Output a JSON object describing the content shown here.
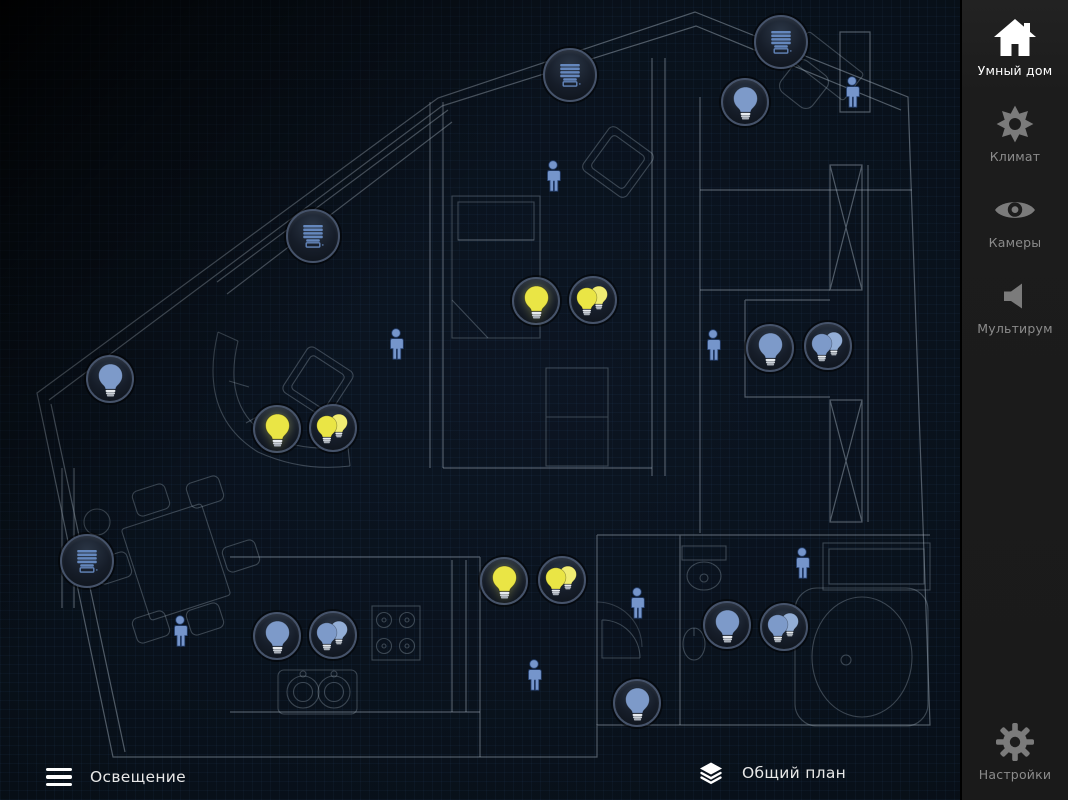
{
  "sidebar": {
    "items": [
      {
        "id": "smart-home",
        "label": "Умный дом",
        "icon": "home-icon",
        "active": true
      },
      {
        "id": "climate",
        "label": "Климат",
        "icon": "sun-icon",
        "active": false
      },
      {
        "id": "cameras",
        "label": "Камеры",
        "icon": "eye-icon",
        "active": false
      },
      {
        "id": "multiroom",
        "label": "Мультирум",
        "icon": "speaker-icon",
        "active": false
      }
    ],
    "settings": {
      "label": "Настройки",
      "icon": "gear-icon"
    }
  },
  "bottom_bar": {
    "lighting_menu": {
      "label": "Освещение",
      "icon": "hamburger-icon"
    },
    "plan_selector": {
      "label": "Общий план",
      "icon": "layers-icon"
    }
  },
  "colors": {
    "light_on": "#eae545",
    "light_on_back": "#f0ec73",
    "light_off": "#7d9ac9",
    "light_off_back": "#93aed6",
    "blinds_icon": "#6487bd",
    "presence": "#7595cb",
    "device_ring": "#46536a",
    "device_bg": "#141b26",
    "sidebar_active": "#ffffff",
    "sidebar_inactive": "#8b8b8b",
    "plan_line": "#a6b4c2"
  },
  "devices": [
    {
      "type": "blinds",
      "x": 570,
      "y": 75
    },
    {
      "type": "blinds",
      "x": 781,
      "y": 42
    },
    {
      "type": "blinds",
      "x": 313,
      "y": 236
    },
    {
      "type": "blinds",
      "x": 87,
      "y": 561
    },
    {
      "type": "light",
      "state": "on",
      "x": 536,
      "y": 301
    },
    {
      "type": "light-group",
      "state": "on",
      "x": 593,
      "y": 300
    },
    {
      "type": "light",
      "state": "on",
      "x": 277,
      "y": 429
    },
    {
      "type": "light-group",
      "state": "on",
      "x": 333,
      "y": 428
    },
    {
      "type": "light",
      "state": "on",
      "x": 504,
      "y": 581
    },
    {
      "type": "light-group",
      "state": "on",
      "x": 562,
      "y": 580
    },
    {
      "type": "light",
      "state": "off",
      "x": 745,
      "y": 102
    },
    {
      "type": "light",
      "state": "off",
      "x": 110,
      "y": 379
    },
    {
      "type": "light",
      "state": "off",
      "x": 770,
      "y": 348
    },
    {
      "type": "light-group",
      "state": "off",
      "x": 828,
      "y": 346
    },
    {
      "type": "light",
      "state": "off",
      "x": 277,
      "y": 636
    },
    {
      "type": "light-group",
      "state": "off",
      "x": 333,
      "y": 635
    },
    {
      "type": "light",
      "state": "off",
      "x": 727,
      "y": 625
    },
    {
      "type": "light-group",
      "state": "off",
      "x": 784,
      "y": 627
    },
    {
      "type": "light",
      "state": "off",
      "x": 637,
      "y": 703
    },
    {
      "type": "presence",
      "x": 553,
      "y": 178
    },
    {
      "type": "presence",
      "x": 852,
      "y": 94
    },
    {
      "type": "presence",
      "x": 396,
      "y": 346
    },
    {
      "type": "presence",
      "x": 713,
      "y": 347
    },
    {
      "type": "presence",
      "x": 180,
      "y": 633
    },
    {
      "type": "presence",
      "x": 534,
      "y": 677
    },
    {
      "type": "presence",
      "x": 637,
      "y": 605
    },
    {
      "type": "presence",
      "x": 802,
      "y": 565
    }
  ]
}
